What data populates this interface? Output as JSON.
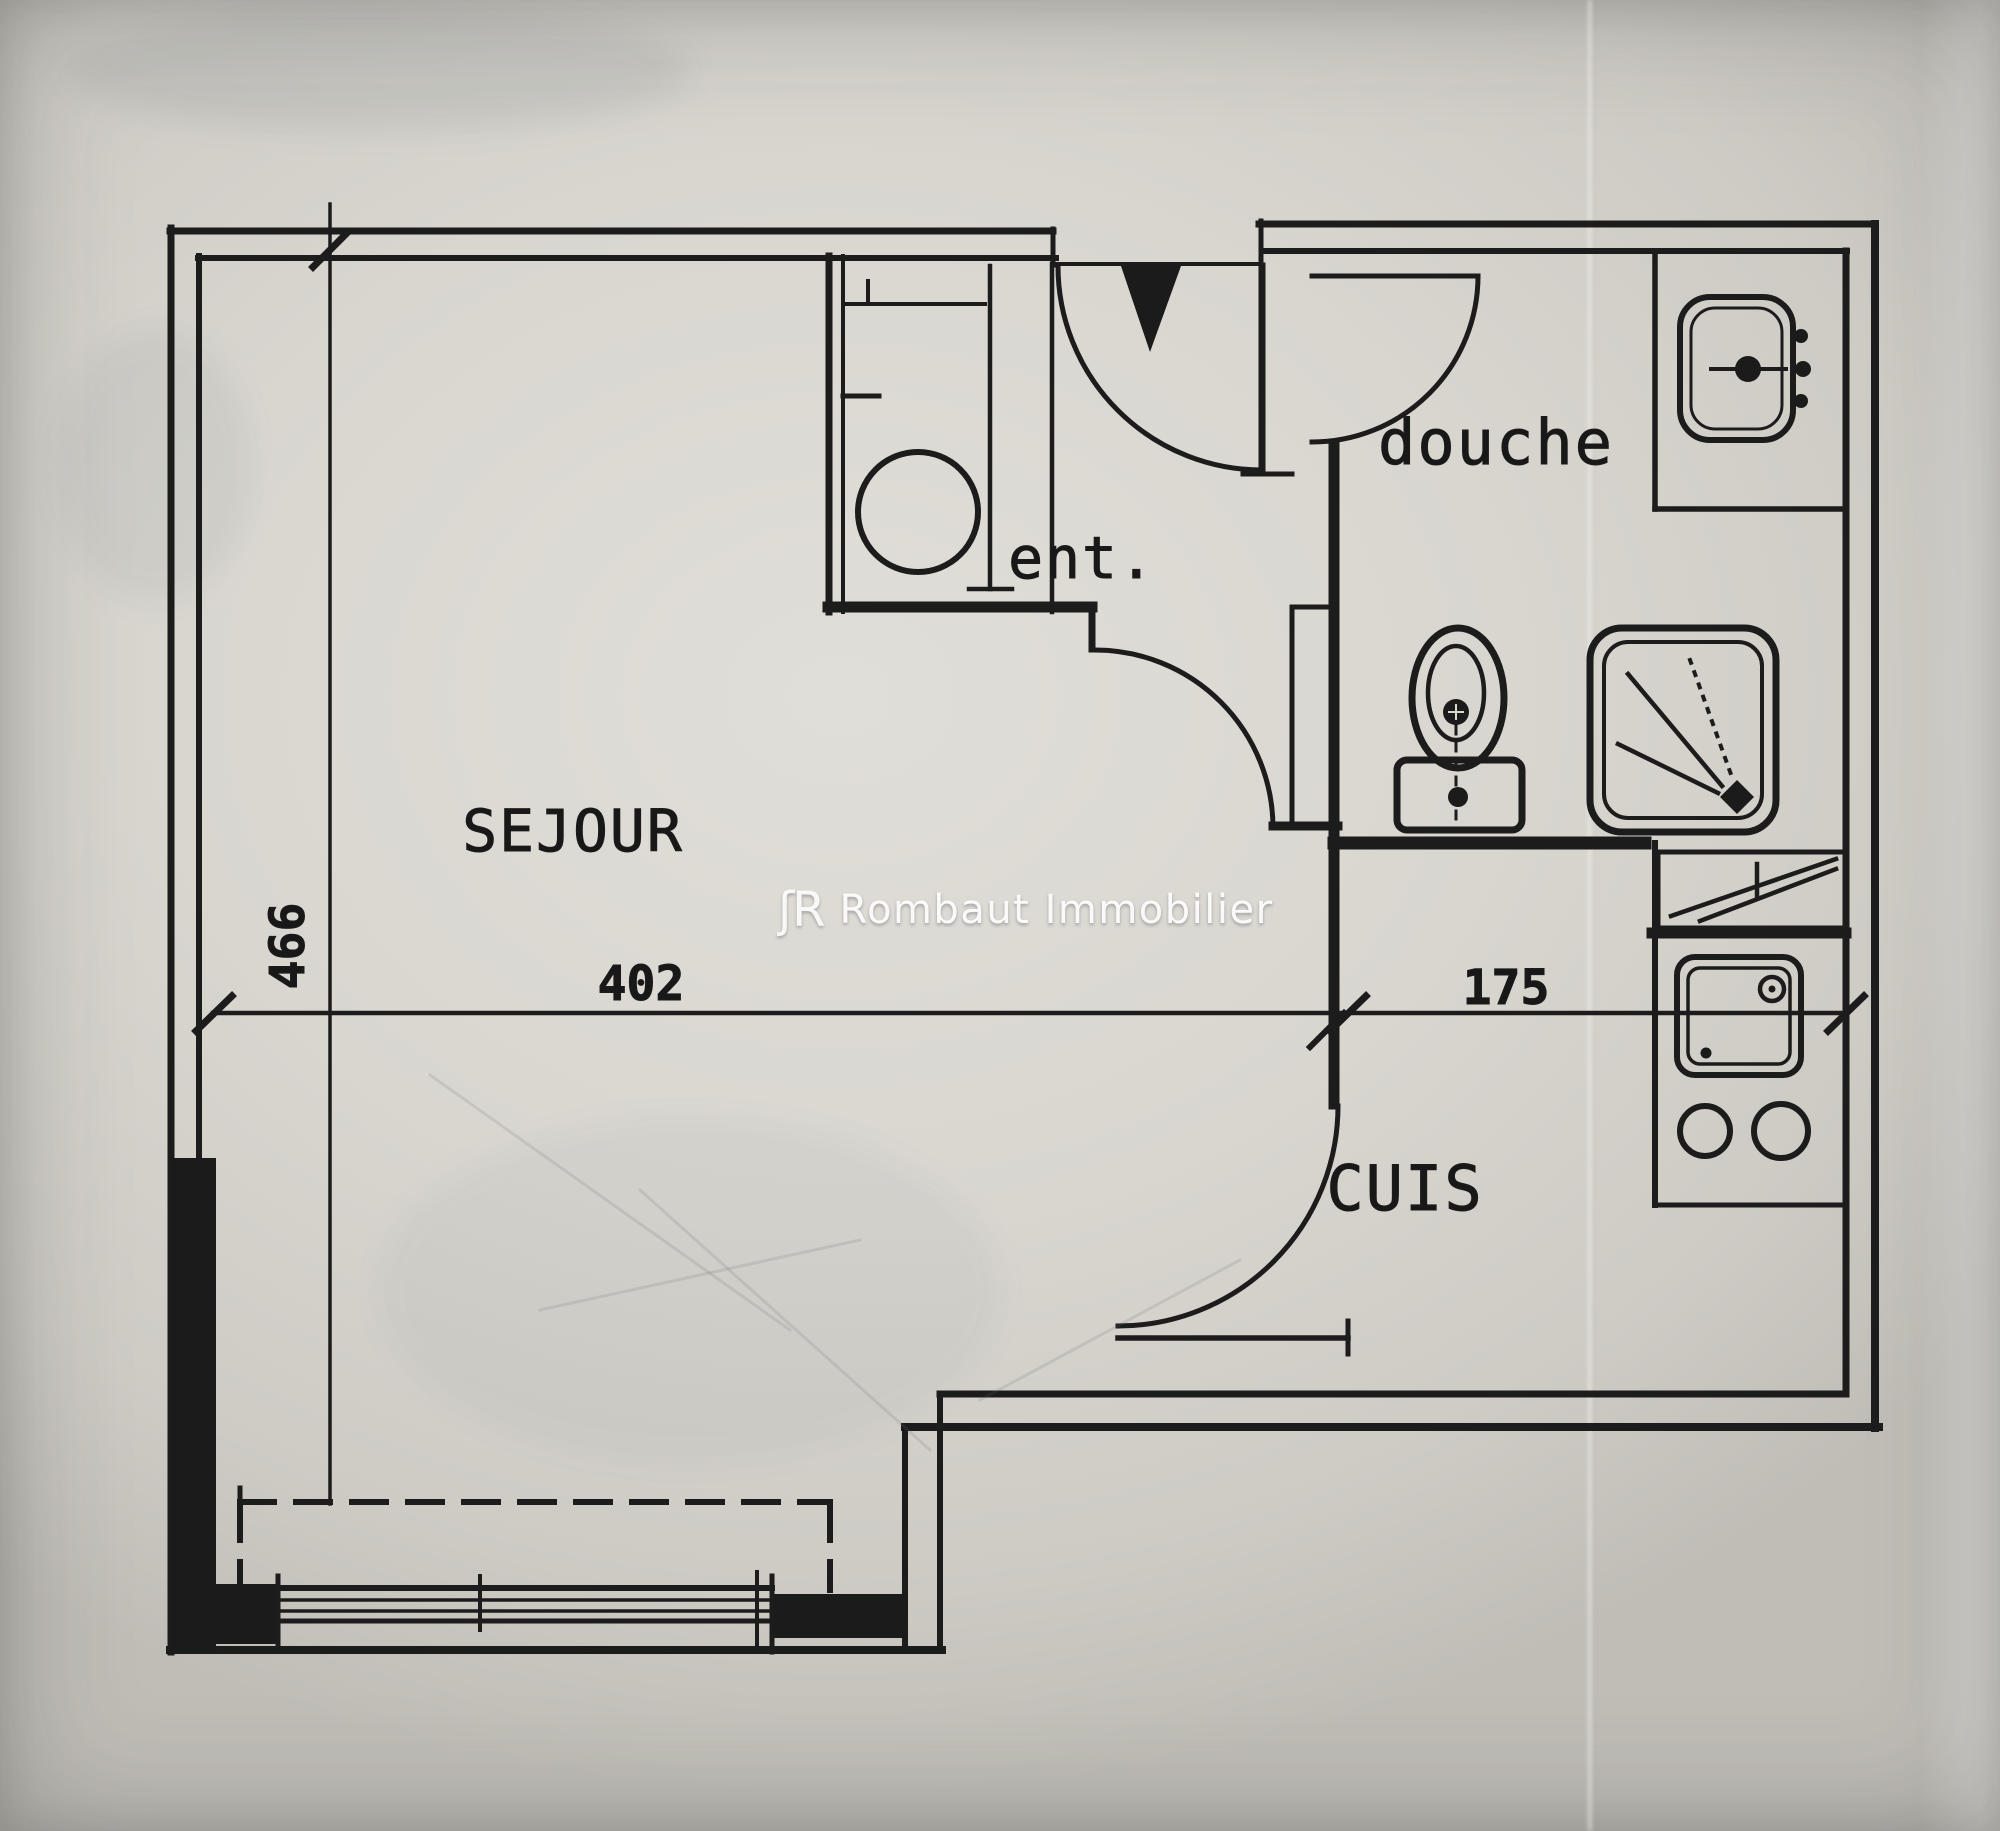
{
  "page": {
    "type": "scanned apartment floor plan (studio)",
    "language": "fr"
  },
  "watermark": {
    "logo_monogram": "ʃR",
    "agency": "Rombaut Immobilier",
    "color": "#ffffff"
  },
  "rooms": [
    {
      "id": "sejour",
      "label": "SEJOUR"
    },
    {
      "id": "entree",
      "label": "ent."
    },
    {
      "id": "douche",
      "label": "douche"
    },
    {
      "id": "cuisine",
      "label": "CUIS"
    }
  ],
  "dimensions_cm": [
    {
      "id": "sejour-width",
      "value": "402",
      "orientation": "horizontal"
    },
    {
      "id": "sejour-depth",
      "value": "466",
      "orientation": "vertical"
    },
    {
      "id": "cuisine-width",
      "value": "175",
      "orientation": "horizontal"
    }
  ],
  "fixtures": [
    {
      "id": "entry-door-swing",
      "room": "entree"
    },
    {
      "id": "entry-threshold-triangle",
      "room": "entree"
    },
    {
      "id": "closet-water-heater",
      "room": "entree"
    },
    {
      "id": "hall-door-swing",
      "room": "entree"
    },
    {
      "id": "bathroom-door-swing",
      "room": "douche"
    },
    {
      "id": "washbasin",
      "room": "douche"
    },
    {
      "id": "toilet",
      "room": "douche"
    },
    {
      "id": "shower-tray",
      "room": "douche"
    },
    {
      "id": "vanity-counter",
      "room": "douche"
    },
    {
      "id": "appliance-box",
      "room": "cuisine"
    },
    {
      "id": "kitchen-sink",
      "room": "cuisine"
    },
    {
      "id": "cooktop-burners",
      "room": "cuisine"
    },
    {
      "id": "kitchen-door-swing",
      "room": "cuisine"
    },
    {
      "id": "sliding-bay-window",
      "room": "sejour"
    },
    {
      "id": "balcony-dashed-outline",
      "room": "sejour"
    },
    {
      "id": "load-bearing-wall",
      "room": "sejour"
    }
  ],
  "colors": {
    "ink": "#1c1c1c",
    "paper": "#d6d4cd",
    "paper_highlight": "#e0ded9",
    "paper_shadow": "#bfbdb6",
    "watermark_text": "#ffffff"
  }
}
